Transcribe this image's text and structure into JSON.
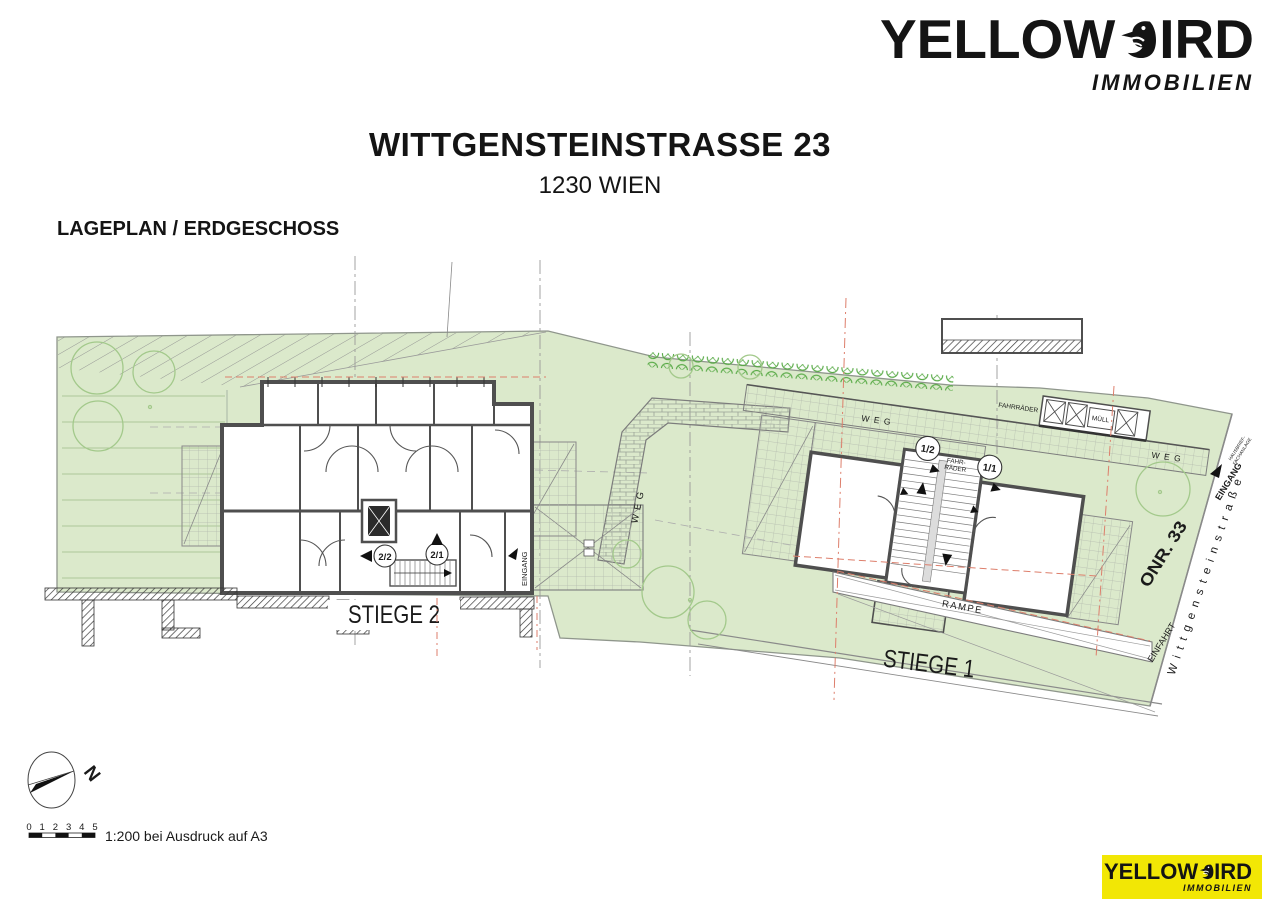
{
  "header": {
    "brand": {
      "left": "YELLOW",
      "right": "IRD",
      "sub": "IMMOBILIEN"
    }
  },
  "title": {
    "main": "WITTGENSTEINSTRASSE 23",
    "sub": "1230 WIEN"
  },
  "plan_caption": "LAGEPLAN / ERDGESCHOSS",
  "plan": {
    "labels": {
      "stiege1": "STIEGE 1",
      "stiege2": "STIEGE 2",
      "u11": "1/1",
      "u12": "1/2",
      "u21": "2/1",
      "u22": "2/2",
      "weg": "WEG",
      "rampe": "RAMPE",
      "einfahrt": "EINFAHRT",
      "eingang": "EINGANG",
      "onr": "ONR. 33",
      "street": "Wittgensteinstraße",
      "fahrraeder": "FAHRRÄDER",
      "fahr1": "FAHR-",
      "fahr2": "RÄDER",
      "muell": "MÜLL",
      "hausbrief1": "HAUSBRIEF-",
      "hausbrief2": "FACHANLAGE"
    }
  },
  "compass": {
    "north": "N"
  },
  "scale": {
    "numbers": [
      "0",
      "1",
      "2",
      "3",
      "4",
      "5"
    ],
    "note": "1:200 bei Ausdruck auf A3"
  },
  "colors": {
    "accent_yellow": "#F2E705",
    "site_green": "#DBE9CB",
    "hedge_green": "#56A944",
    "marker_red": "#DD7E6B"
  }
}
